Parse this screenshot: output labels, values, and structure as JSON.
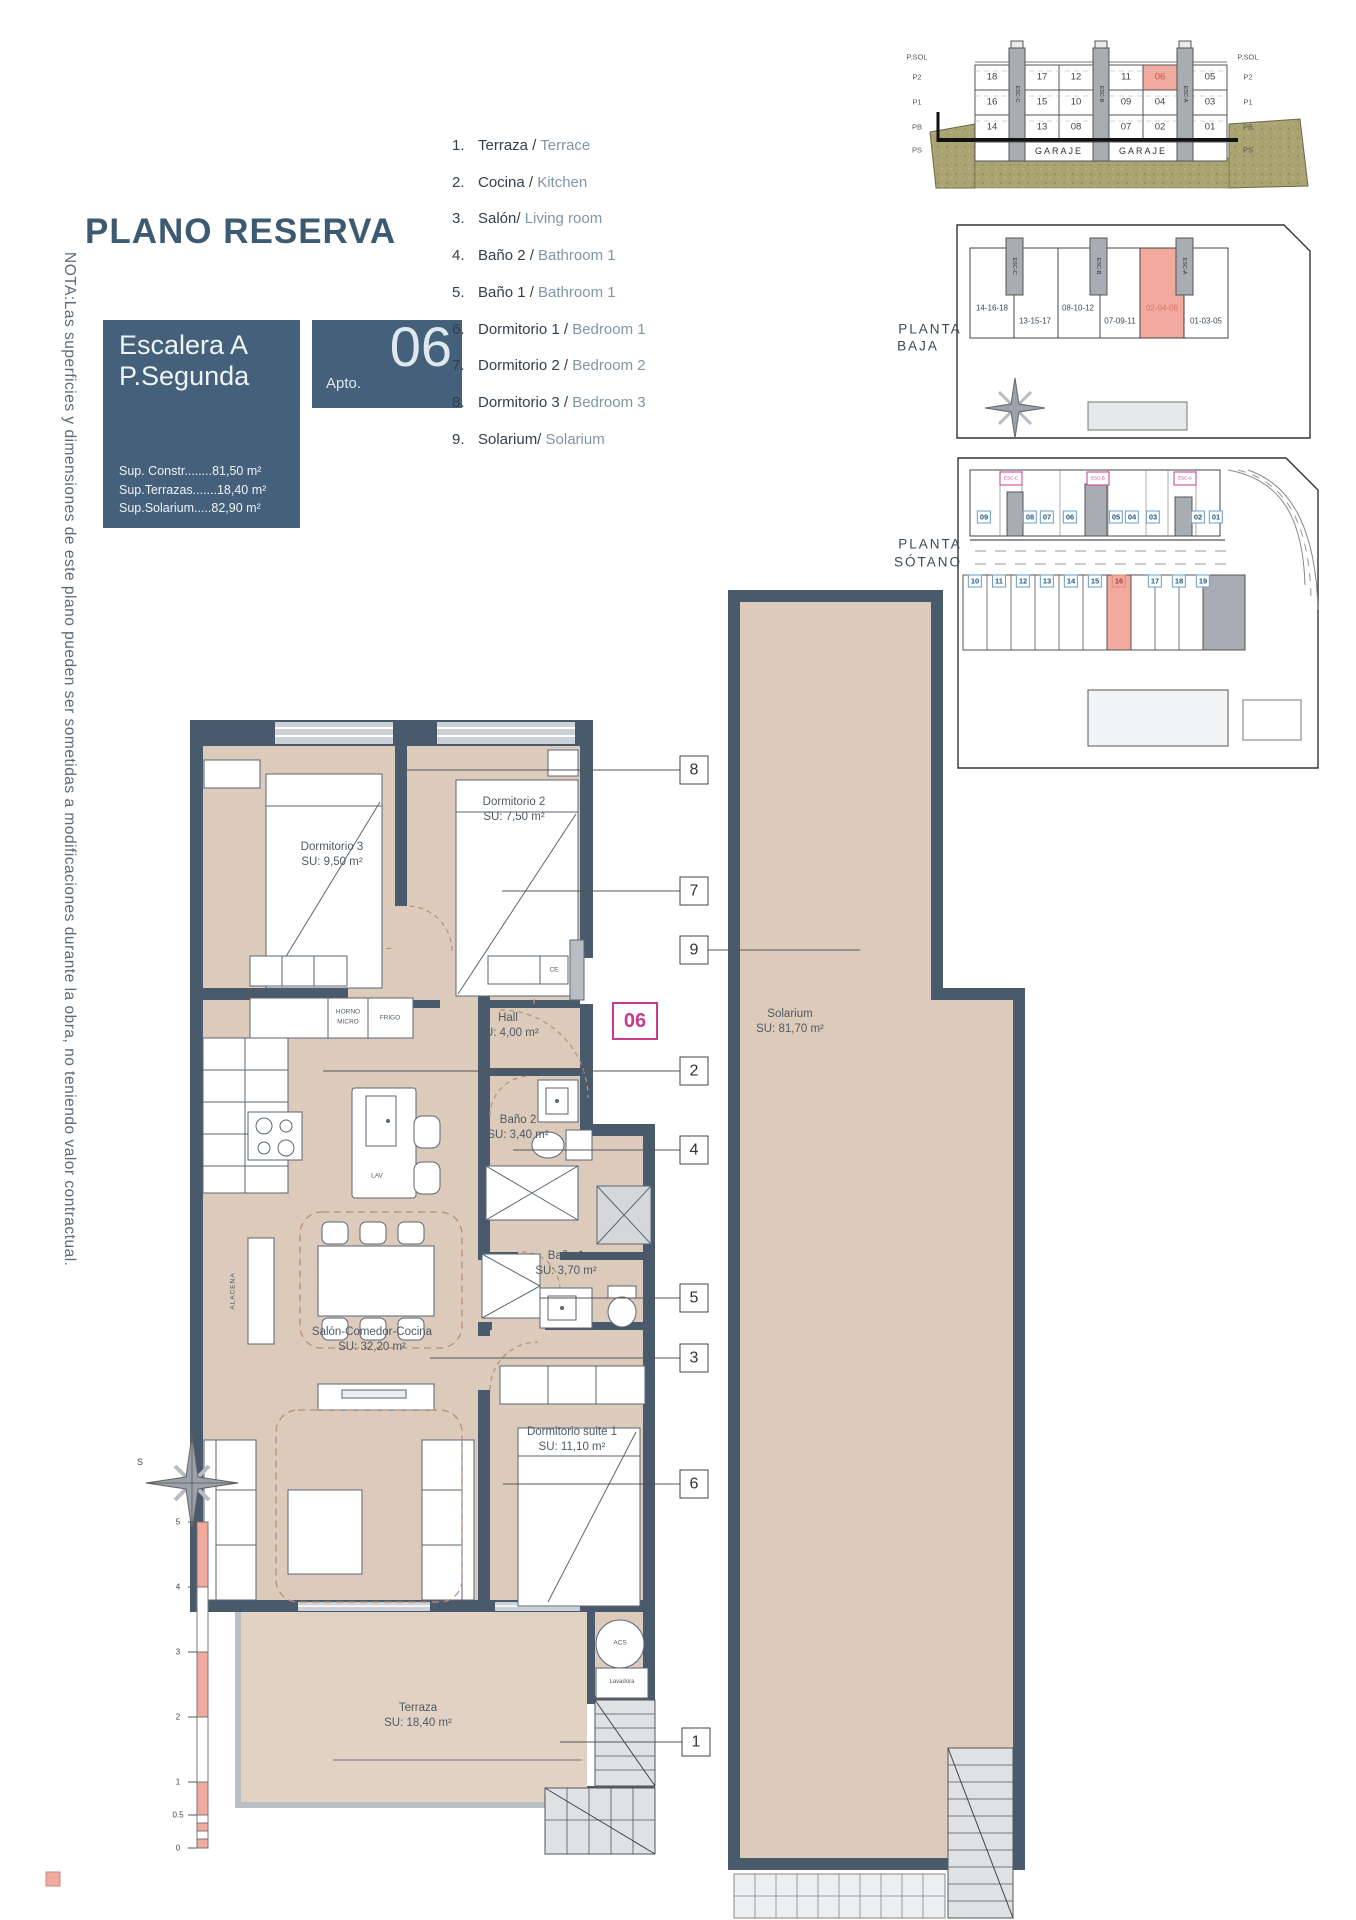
{
  "note": "NOTA:Las superficies y dimensiones de este plano pueden ser sometidas a modificaciones durante la obra, no teniendo valor contractual.",
  "title": "PLANO RESERVA",
  "reserva": {
    "escalera": "Escalera A",
    "planta": "P.Segunda",
    "apto_prefix": "Apto.",
    "apto_num": "06",
    "sups": [
      "Sup. Constr........81,50 m²",
      "Sup.Terrazas.......18,40 m²",
      "Sup.Solarium.....82,90 m²"
    ]
  },
  "legend": [
    {
      "num": "1.",
      "es": "Terraza /",
      "en": "Terrace"
    },
    {
      "num": "2.",
      "es": "Cocina /",
      "en": "Kitchen"
    },
    {
      "num": "3.",
      "es": "Salón/",
      "en": "Living room"
    },
    {
      "num": "4.",
      "es": "Baño 2 /",
      "en": "Bathroom 1"
    },
    {
      "num": "5.",
      "es": "Baño 1 /",
      "en": "Bathroom 1"
    },
    {
      "num": "6.",
      "es": "Dormitorio 1 /",
      "en": "Bedroom 1"
    },
    {
      "num": "7.",
      "es": "Dormitorio 2 /",
      "en": "Bedroom 2"
    },
    {
      "num": "8.",
      "es": "Dormitorio 3 /",
      "en": "Bedroom 3"
    },
    {
      "num": "9.",
      "es": "Solarium/",
      "en": "Solarium"
    }
  ],
  "section": {
    "floors": [
      "P.SOL",
      "P2",
      "P1",
      "PB",
      "PS"
    ],
    "units": [
      "18",
      "17",
      "12",
      "11",
      "06",
      "05",
      "16",
      "15",
      "10",
      "09",
      "04",
      "03",
      "14",
      "13",
      "08",
      "07",
      "02",
      "01"
    ],
    "highlight_unit": "06",
    "towers": [
      "ESC-C",
      "ESC-B",
      "ESC-A"
    ],
    "garaje": [
      "GARAJE",
      "GARAJE"
    ]
  },
  "planta_baja": {
    "label_1": "PLANTA",
    "label_2": "BAJA",
    "groups": [
      "14-16-18",
      "13-15-17",
      "08-10-12",
      "07-09-11",
      "02-04-06",
      "01-03-05"
    ],
    "highlight_group": "02-04-06",
    "towers": [
      "ESC-C",
      "ESC-B",
      "ESC-A"
    ]
  },
  "planta_sotano": {
    "label_1": "PLANTA",
    "label_2": "SÓTANO",
    "top_spots": [
      "09",
      "08",
      "07",
      "06",
      "05",
      "04",
      "03",
      "02",
      "01"
    ],
    "bottom_spots": [
      "10",
      "11",
      "12",
      "13",
      "14",
      "15",
      "16",
      "17",
      "18",
      "19"
    ],
    "highlight_spot": "16",
    "esc_tags": [
      "ESC-C",
      "ESC-B",
      "ESC-A"
    ]
  },
  "unit_badge": "06",
  "callouts": [
    "8",
    "7",
    "9",
    "2",
    "4",
    "5",
    "3",
    "6",
    "1"
  ],
  "rooms": {
    "dorm3": {
      "name": "Dormitorio 3",
      "area": "SU: 9,50 m²"
    },
    "dorm2": {
      "name": "Dormitorio 2",
      "area": "SU: 7,50 m²"
    },
    "hall": {
      "name": "Hall",
      "area": "SU: 4,00 m²"
    },
    "bano2": {
      "name": "Baño 2",
      "area": "SU: 3,40 m²"
    },
    "bano1": {
      "name": "Baño 1",
      "area": "SU: 3,70 m²"
    },
    "salon": {
      "name": "Salón-Comedor-Cocina",
      "area": "SU: 32,20 m²"
    },
    "suite": {
      "name": "Dormitorio suite 1",
      "area": "SU: 11,10 m²"
    },
    "terraza": {
      "name": "Terraza",
      "area": "SU: 18,40 m²"
    },
    "solarium": {
      "name": "Solarium",
      "area": "SU: 81,70 m²"
    }
  },
  "fixtures": {
    "horno_1": "HORNO",
    "horno_2": "MICRO",
    "frigo": "FRIGO",
    "lav": "LAV",
    "alacena": "ALACENA",
    "ce": "CE",
    "acs": "ACS",
    "lavadora": "Lavadora"
  },
  "compass_s": "S",
  "scale_labels": [
    "5",
    "4",
    "3",
    "2",
    "1",
    "0.5",
    "0"
  ],
  "colors": {
    "accent_slate": "#45607a",
    "wall_slate": "#4a5a6d",
    "floor_tan": "#dccabb",
    "terrace_tan": "#e1d2c4",
    "salmon": "#f2a99e",
    "magenta": "#c73a8e",
    "khaki_ground": "#a9a471",
    "parking_blue": "#1b5c86",
    "english_gray": "#7f96a5"
  }
}
